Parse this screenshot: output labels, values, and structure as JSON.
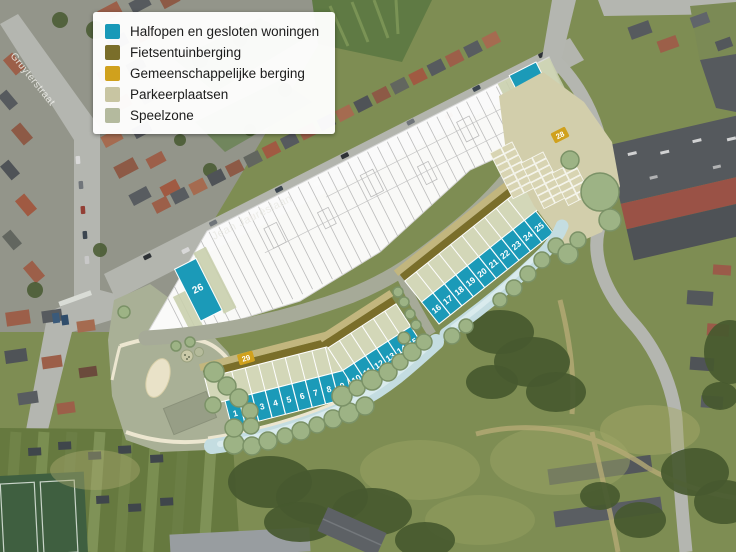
{
  "legend": {
    "items": [
      {
        "label": "Halfopen en gesloten woningen",
        "color": "#1899b8"
      },
      {
        "label": "Fietsentuinberging",
        "color": "#7a6e2a"
      },
      {
        "label": "Gemeenschappelijke berging",
        "color": "#d0a11d"
      },
      {
        "label": "Parkeerplaatsen",
        "color": "#c8c5a2"
      },
      {
        "label": "Speelzone",
        "color": "#b4ba9e"
      }
    ]
  },
  "streets": [
    {
      "name": "Gruyterstraat"
    },
    {
      "name": "Jean Jaurèslaan"
    }
  ],
  "site": {
    "house_color": "#1b9ab8",
    "lot_rows": [
      {
        "numbers": [
          "1",
          "2",
          "3",
          "4",
          "5",
          "6",
          "7",
          "8",
          "9"
        ]
      },
      {
        "numbers": [
          "10",
          "11",
          "12",
          "13",
          "14",
          "15"
        ]
      },
      {
        "numbers": [
          "16",
          "17",
          "18",
          "19",
          "20",
          "21",
          "22",
          "23",
          "24",
          "25"
        ]
      }
    ],
    "single_lots": [
      {
        "number": "26"
      },
      {
        "number": "27"
      }
    ],
    "shared_storage_markers": [
      {
        "number": "28"
      },
      {
        "number": "29"
      }
    ]
  }
}
